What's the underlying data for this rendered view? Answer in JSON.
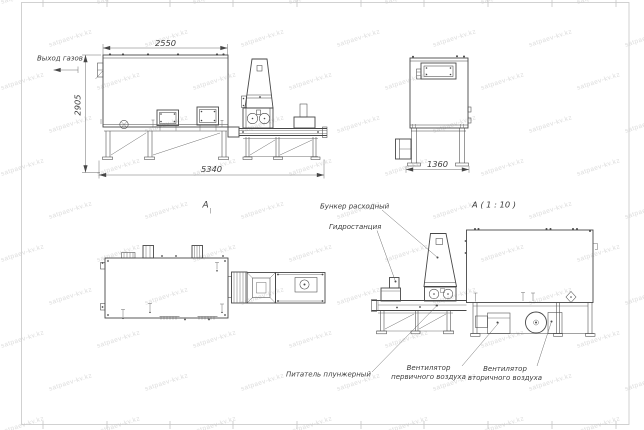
{
  "sheet": {
    "watermark_text": "satpaev-kv.kz",
    "colors": {
      "line": "#474747",
      "thin": "#5f5f5f",
      "frame": "#c6c6c6",
      "text": "#3c3c3c",
      "watermark": "#dcdcdc",
      "background": "#ffffff"
    }
  },
  "front_view": {
    "gas_outlet_label": "Выход газов",
    "dim_body_width": "2550",
    "dim_height": "2905",
    "dim_total_length": "5340",
    "section_label": "А"
  },
  "side_view": {
    "dim_width": "1360"
  },
  "detail_view": {
    "title": "А ( 1 : 10 )",
    "callout_hopper": "Бункер расходный",
    "callout_hydrostation": "Гидростанция",
    "callout_feeder": "Питатель плунжерный",
    "callout_primary_fan": [
      "Вентилятор",
      "первичного воздуха"
    ],
    "callout_secondary_fan": [
      "Вентилятор",
      "вторичного воздуха"
    ]
  }
}
